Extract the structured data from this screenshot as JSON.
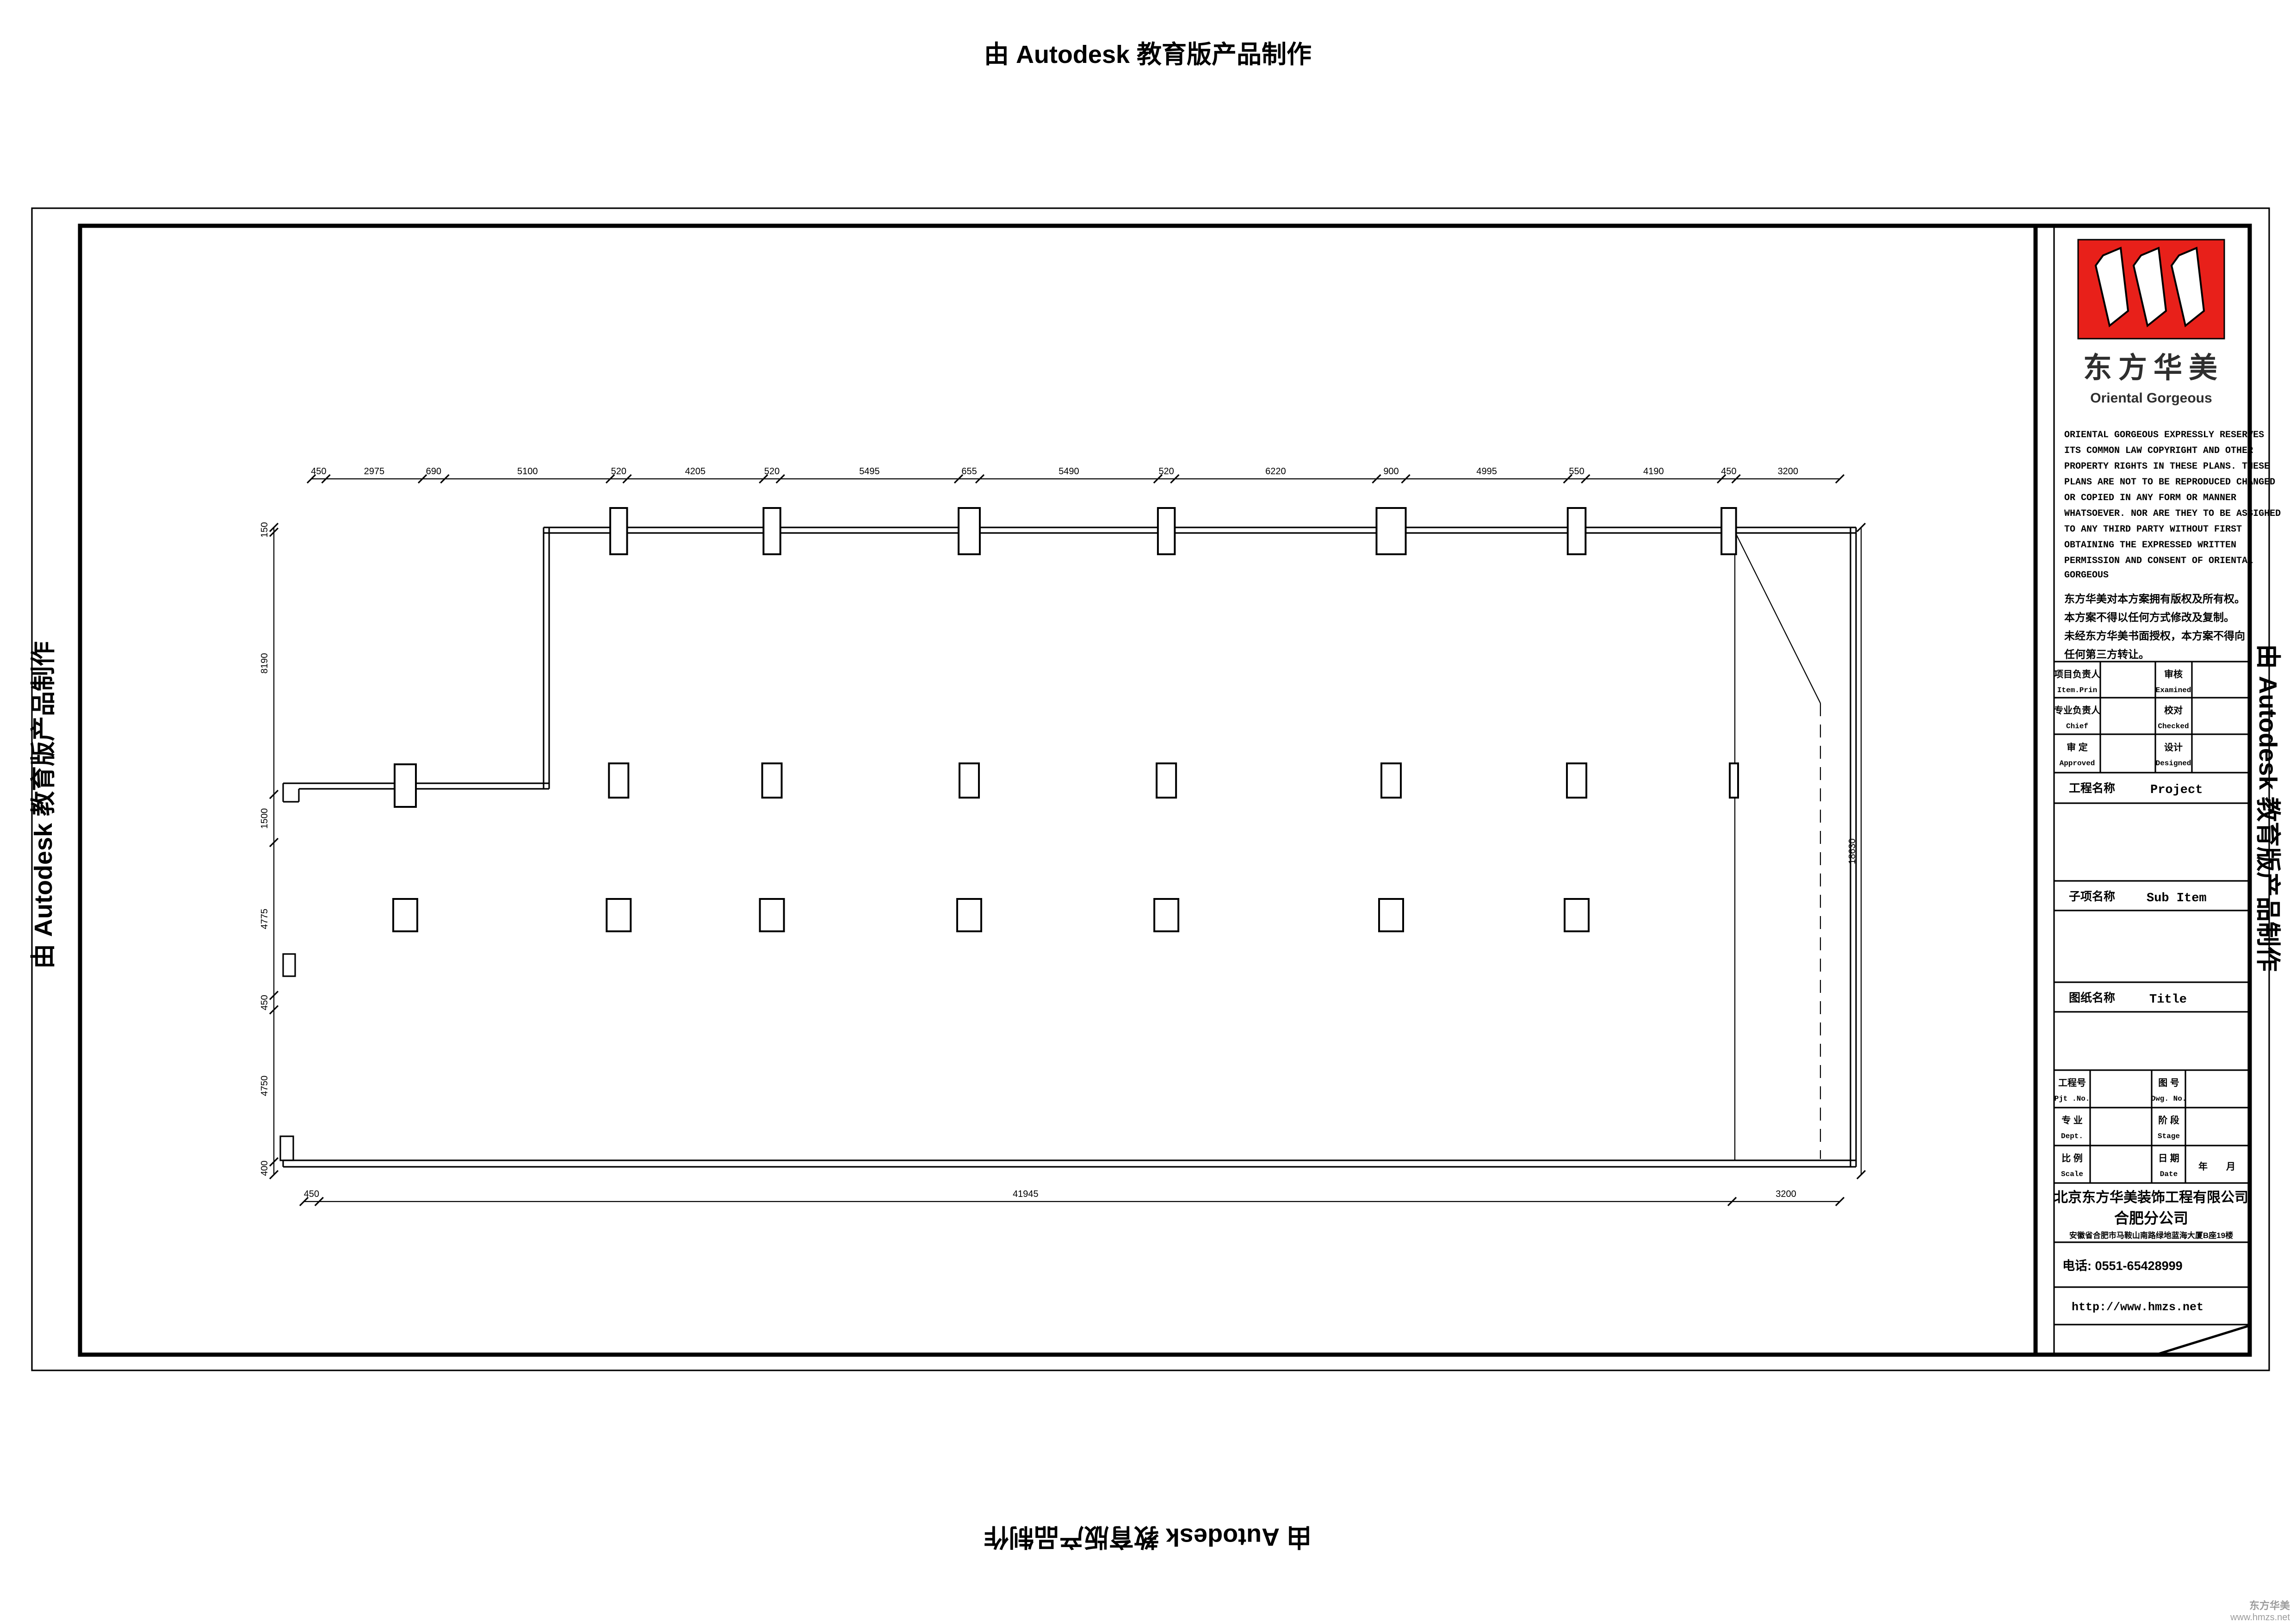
{
  "banner": {
    "text": "由 Autodesk 教育版产品制作"
  },
  "watermark": {
    "line1": "东方华美",
    "line2": "www.hmzs.net"
  },
  "colors": {
    "logo_red": "#e8201a",
    "line_black": "#000000",
    "watermark_gray": "#9b9b9b"
  },
  "title_block": {
    "logo": {
      "brand_cn": "东方华美",
      "brand_en": "Oriental  Gorgeous",
      "mark": "triple-slanted-bars-icon"
    },
    "copyright_en_lines": [
      "ORIENTAL GORGEOUS EXPRESSLY RESERVES",
      "ITS COMMON LAW COPYRIGHT AND OTHER",
      "PROPERTY RIGHTS IN THESE PLANS. THESE",
      "PLANS ARE NOT TO BE REPRODUCED CHANGED",
      "OR COPIED IN ANY FORM OR MANNER",
      "WHATSOEVER. NOR ARE THEY TO BE ASSIGHED",
      "TO ANY THIRD PARTY WITHOUT FIRST",
      "OBTAINING THE EXPRESSED WRITTEN",
      "PERMISSION AND CONSENT OF ORIENTAL",
      "GORGEOUS"
    ],
    "copyright_cn_lines": [
      "东方华美对本方案拥有版权及所有权。",
      "本方案不得以任何方式修改及复制。",
      "未经东方华美书面授权，本方案不得向",
      "任何第三方转让。"
    ],
    "sign_rows": [
      {
        "label_cn": "项目负责人",
        "label_en": "Item.Prin",
        "value": "",
        "label2_cn": "审核",
        "label2_en": "Examined",
        "value2": ""
      },
      {
        "label_cn": "专业负责人",
        "label_en": "Chief",
        "value": "",
        "label2_cn": "校对",
        "label2_en": "Checked",
        "value2": ""
      },
      {
        "label_cn": "审 定",
        "label_en": "Approved",
        "value": "",
        "label2_cn": "设计",
        "label2_en": "Designed",
        "value2": ""
      }
    ],
    "project_label": {
      "cn": "工程名称",
      "en": "Project",
      "value": ""
    },
    "subitem_label": {
      "cn": "子项名称",
      "en": "Sub Item",
      "value": ""
    },
    "title_label": {
      "cn": "图纸名称",
      "en": "Title",
      "value": ""
    },
    "info_rows": [
      {
        "label_cn": "工程号",
        "label_en": "Pjt .No.",
        "value": "",
        "label2_cn": "图 号",
        "label2_en": "Dwg. No.",
        "value2": ""
      },
      {
        "label_cn": "专 业",
        "label_en": "Dept.",
        "value": "",
        "label2_cn": "阶 段",
        "label2_en": "Stage",
        "value2": ""
      },
      {
        "label_cn": "比 例",
        "label_en": "Scale",
        "value": "",
        "label2_cn": "日 期",
        "label2_en": "Date",
        "value2": "年　　月"
      }
    ],
    "company": {
      "name": "北京东方华美装饰工程有限公司",
      "branch": "合肥分公司",
      "address": "安徽省合肥市马鞍山南路绿地蓝海大厦B座19楼",
      "phone": "电话: 0551-65428999",
      "website": "http://www.hmzs.net"
    }
  },
  "chart_data": {
    "type": "table",
    "title": "Column grid floor plan dimensions (mm)",
    "top_dimensions": [
      450,
      2975,
      690,
      5100,
      520,
      4205,
      520,
      5495,
      655,
      5490,
      520,
      6220,
      900,
      4995,
      550,
      4190,
      450,
      3200
    ],
    "left_dimensions": [
      150,
      8190,
      1500,
      4775,
      450,
      4750,
      400
    ],
    "bottom_dimensions": [
      450,
      41945,
      3200
    ],
    "right_dimension": 18630
  },
  "plan": {
    "dims_top": [
      450,
      2975,
      690,
      5100,
      520,
      4205,
      520,
      5495,
      655,
      5490,
      520,
      6220,
      900,
      4995,
      550,
      4190,
      450,
      3200
    ],
    "dims_left": [
      150,
      8190,
      1500,
      4775,
      450,
      4750,
      400
    ],
    "dims_bottom": [
      450,
      41945,
      3200
    ],
    "dim_right": 18630
  }
}
